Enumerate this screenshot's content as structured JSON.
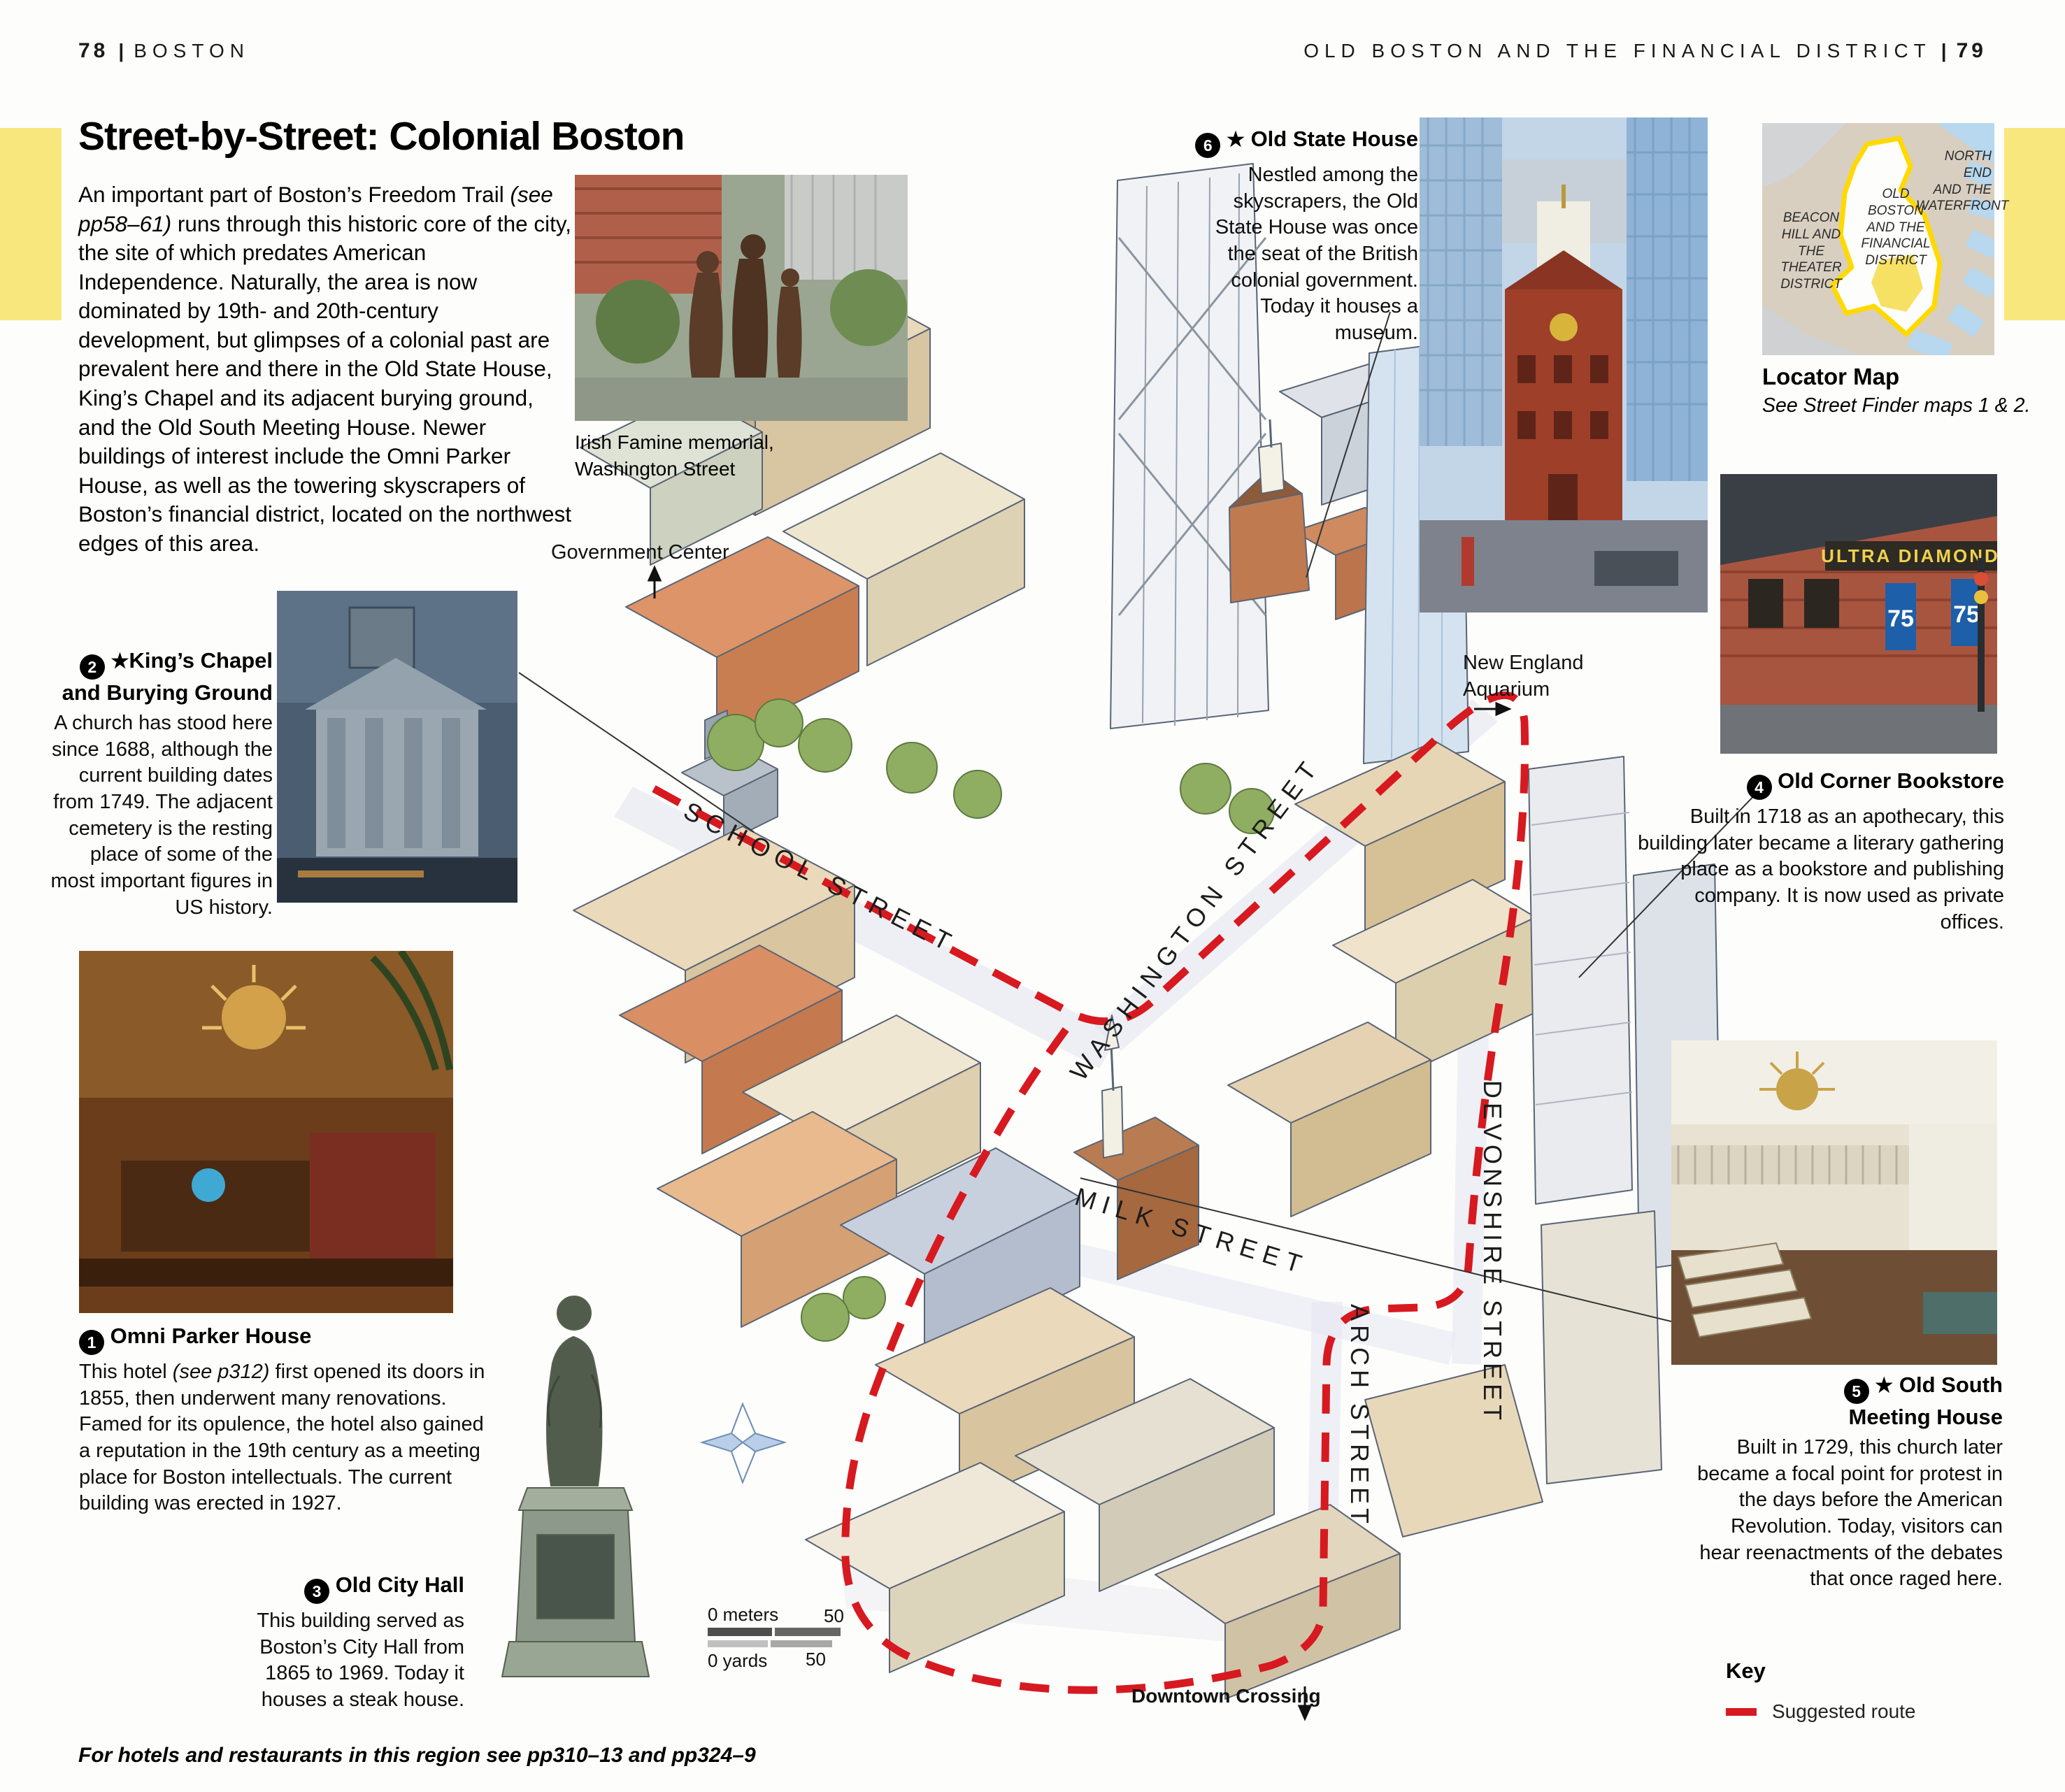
{
  "colors": {
    "route_red": "#d71920",
    "tab_yellow": "#f8e77d",
    "locator_outline_yellow": "#ffd900"
  },
  "header": {
    "left_page": "78",
    "left_section": "BOSTON",
    "right_section": "OLD BOSTON AND THE FINANCIAL DISTRICT",
    "right_page": "79",
    "divider": "|"
  },
  "intro": {
    "title": "Street-by-Street: Colonial Boston",
    "body_pre": "An important part of Boston’s Freedom Trail ",
    "body_italic": "(see pp58–61)",
    "body_post": " runs through this historic core of the city, the site of which predates American Independence. Naturally, the area is now dominated by 19th- and 20th-century development, but glimpses of a colonial past are prevalent here and there in the Old State House, King’s Chapel and its adjacent burying ground, and the Old South Meeting House. Newer buildings of interest include the Omni Parker House, as well as the towering skyscrapers of Boston’s financial district, located on the northwest edges of this area."
  },
  "callouts": {
    "omni_parker": {
      "number": "1",
      "title": "Omni Parker House",
      "body_pre": "This hotel ",
      "body_italic": "(see p312)",
      "body_post": " first opened its doors in 1855, then underwent many renovations. Famed for its opulence, the hotel also gained a reputation in the 19th century as a meeting place for Boston intellectuals. The current building was erected in 1927."
    },
    "kings_chapel": {
      "number": "2",
      "star": "★",
      "title": "King’s Chapel and Burying Ground",
      "body": "A church has stood here since 1688, although the current building dates from 1749. The adjacent cemetery is the resting place of some of the most important figures in US history."
    },
    "old_city_hall": {
      "number": "3",
      "title": "Old City Hall",
      "body": "This building served as Boston’s City Hall from 1865 to 1969. Today it houses a steak house."
    },
    "old_corner_bookstore": {
      "number": "4",
      "title": "Old Corner Bookstore",
      "body": "Built in 1718 as an apothecary, this building later became a literary gathering place as a bookstore and publishing company. It is now used as private offices."
    },
    "old_south_meeting_house": {
      "number": "5",
      "star": "★",
      "title": "Old South Meeting House",
      "body": "Built in 1729, this church later became a focal point for protest in the days before the American Revolution. Today, visitors can hear reenactments of the debates that once raged here."
    },
    "old_state_house": {
      "number": "6",
      "star": "★",
      "title": "Old State House",
      "body": "Nestled among the skyscrapers, the Old State House was once the seat of the British colonial government. Today it houses a museum."
    }
  },
  "map": {
    "streets": {
      "school": "SCHOOL STREET",
      "washington": "WASHINGTON STREET",
      "milk": "MILK STREET",
      "devonshire": "DEVONSHIRE STREET",
      "arch": "ARCH STREET"
    },
    "labels": {
      "government_center": "Government Center",
      "new_england_aquarium": "New England\nAquarium",
      "downtown_crossing": "Downtown Crossing"
    },
    "scale": {
      "meters_zero": "0 meters",
      "meters_max": "50",
      "yards_zero": "0 yards",
      "yards_max": "50"
    },
    "irish_famine_caption": "Irish Famine memorial,\nWashington Street"
  },
  "locator": {
    "north_end": "NORTH END\nAND THE\nWATERFRONT",
    "old_boston": "OLD\nBOSTON\nAND THE\nFINANCIAL\nDISTRICT",
    "beacon_hill": "BEACON\nHILL AND\nTHE\nTHEATER\nDISTRICT",
    "caption_title": "Locator Map",
    "caption_sub": "See Street Finder maps 1 & 2."
  },
  "key": {
    "title": "Key",
    "suggested_route": "Suggested route"
  },
  "photos": {
    "old_corner_sign": "ULTRA DIAMOND",
    "old_corner_banner": "75"
  },
  "footer": "For hotels and restaurants in this region see pp310–13 and pp324–9"
}
